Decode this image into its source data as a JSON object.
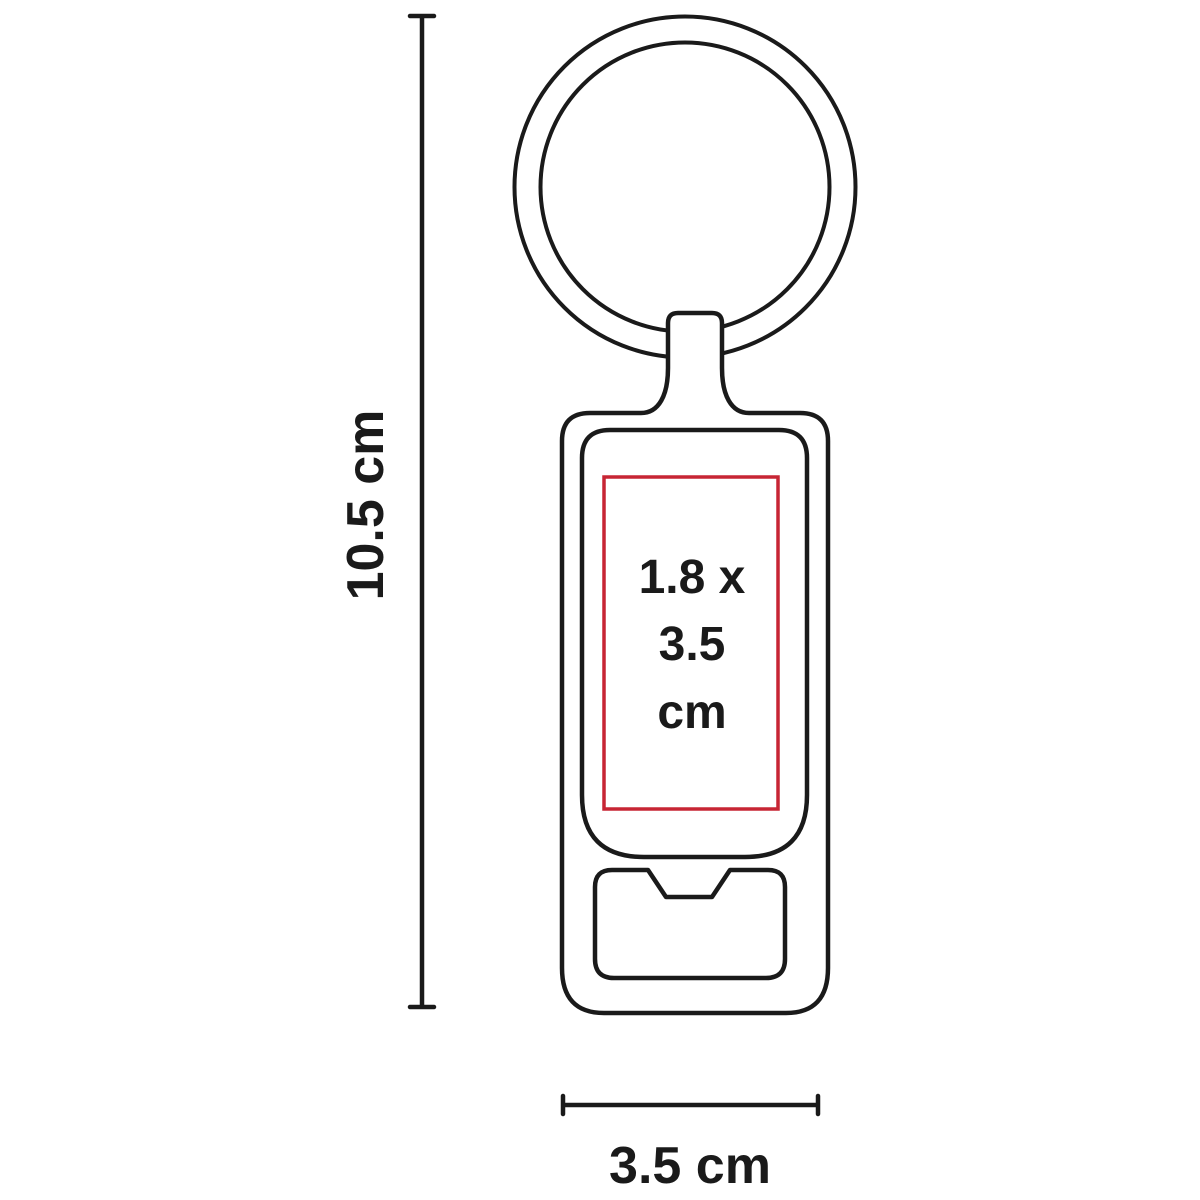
{
  "diagram": {
    "height_dimension": {
      "label": "10.5 cm"
    },
    "width_dimension": {
      "label": "3.5 cm"
    },
    "print_area": {
      "line1": "1.8 x",
      "line2": "3.5",
      "line3": "cm"
    },
    "colors": {
      "line": "#1a1a1a",
      "print_area_accent": "#c72534",
      "background": "#ffffff"
    }
  }
}
